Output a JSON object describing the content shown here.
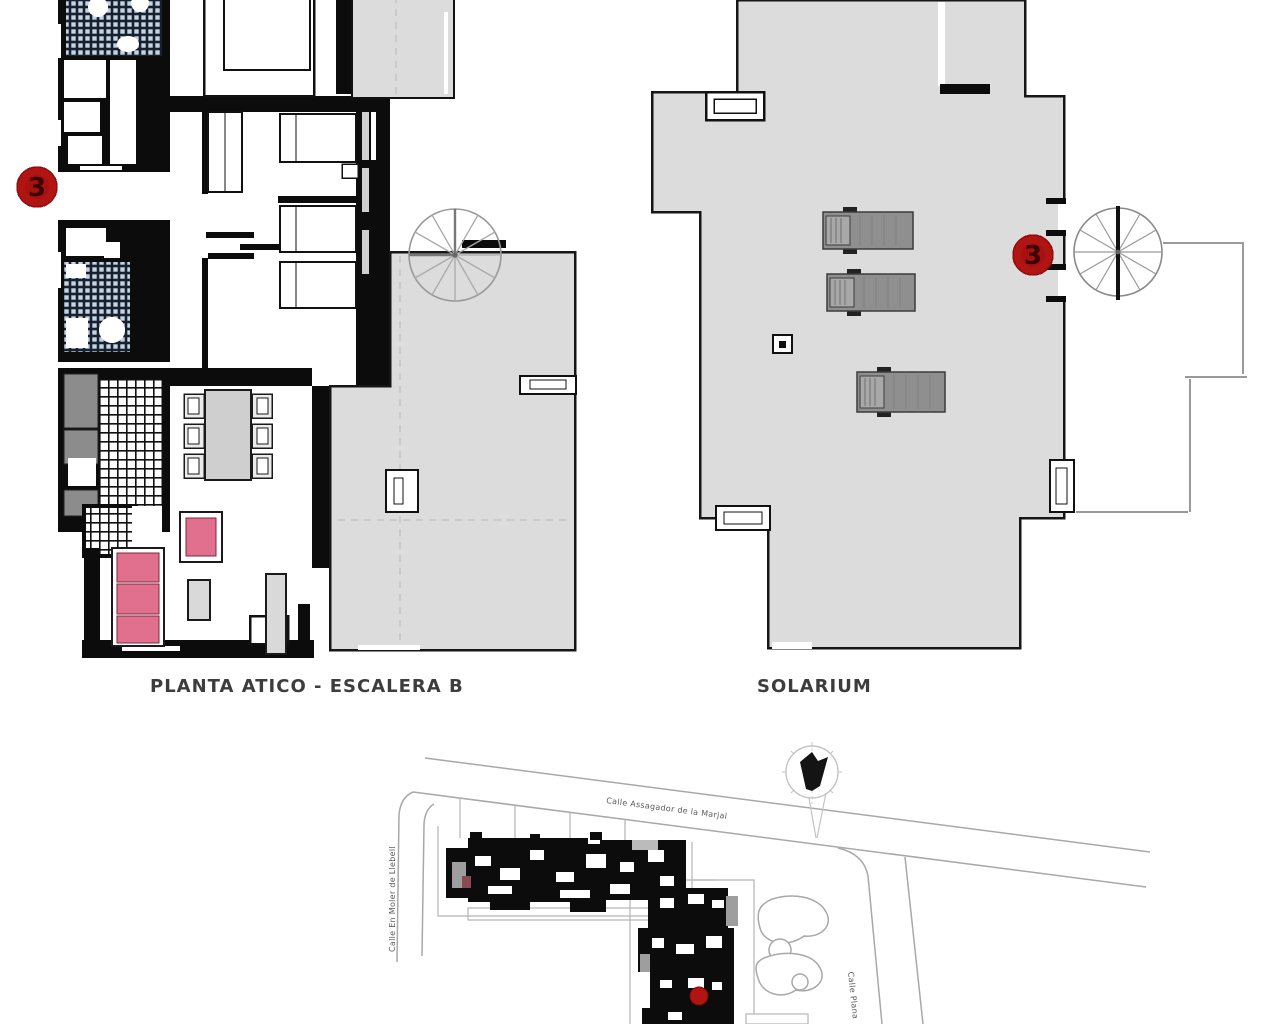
{
  "page": {
    "background": "#ffffff"
  },
  "plans": {
    "atico": {
      "caption": "PLANTA ATICO - ESCALERA B",
      "marker": {
        "label": "3"
      }
    },
    "solarium": {
      "caption": "SOLARIUM",
      "marker": {
        "label": "3"
      }
    }
  },
  "site_plan": {
    "streets": [
      {
        "name": "Calle Assagador de la Marjal"
      },
      {
        "name": "Calle En Moler de Llebell"
      },
      {
        "name": "Calle Plana"
      }
    ]
  },
  "colors": {
    "wall": "#0c0c0c",
    "terrace_gray": "#dcdcdc",
    "marker_red": "#b21414",
    "sofa_pink": "#e0708e",
    "lounger_gray": "#8f8f8f",
    "counter_gray": "#8c8c8c",
    "line_gray": "#a8a8a8",
    "tile_blue": "#c6d3e2"
  }
}
